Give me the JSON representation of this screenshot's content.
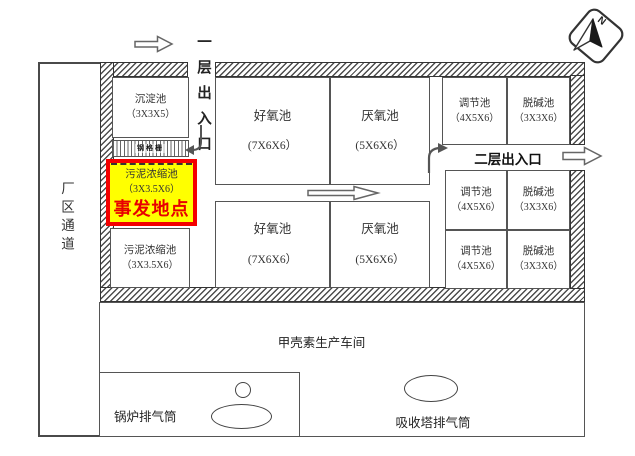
{
  "labels": {
    "incident": "事发地点",
    "first_floor_entrance": "一层出入口",
    "second_floor_entrance": "二层出入口",
    "factory_corridor": "厂区通道",
    "workshop": "甲壳素生产车间",
    "boiler_stack": "锅炉排气筒",
    "absorber_stack": "吸收塔排气筒",
    "compass_north": "N"
  },
  "tanks": {
    "settling": {
      "name": "沉淀池",
      "size": "（3X3X5）"
    },
    "grating": {
      "name": "钢格栅"
    },
    "sludge_incident": {
      "name": "污泥浓缩池",
      "size": "（3X3.5X6）"
    },
    "sludge2": {
      "name": "污泥浓缩池",
      "size": "（3X3.5X6）"
    },
    "aerobic1": {
      "name": "好氧池",
      "size": "(7X6X6）"
    },
    "anaerobic1": {
      "name": "厌氧池",
      "size": "(5X6X6）"
    },
    "aerobic2": {
      "name": "好氧池",
      "size": "(7X6X6）"
    },
    "anaerobic2": {
      "name": "厌氧池",
      "size": "(5X6X6）"
    },
    "regulating1": {
      "name": "调节池",
      "size": "（4X5X6）"
    },
    "dealkali1": {
      "name": "脱碱池",
      "size": "（3X3X6）"
    },
    "regulating2": {
      "name": "调节池",
      "size": "（4X5X6）"
    },
    "dealkali2": {
      "name": "脱碱池",
      "size": "（3X3X6）"
    },
    "regulating3": {
      "name": "调节池",
      "size": "（4X5X6）"
    },
    "dealkali3": {
      "name": "脱碱池",
      "size": "（3X3X6）"
    }
  },
  "colors": {
    "incident_fill": "#ffff00",
    "incident_border": "#f40000",
    "incident_text": "#e80000",
    "line": "#4a4a4a"
  }
}
